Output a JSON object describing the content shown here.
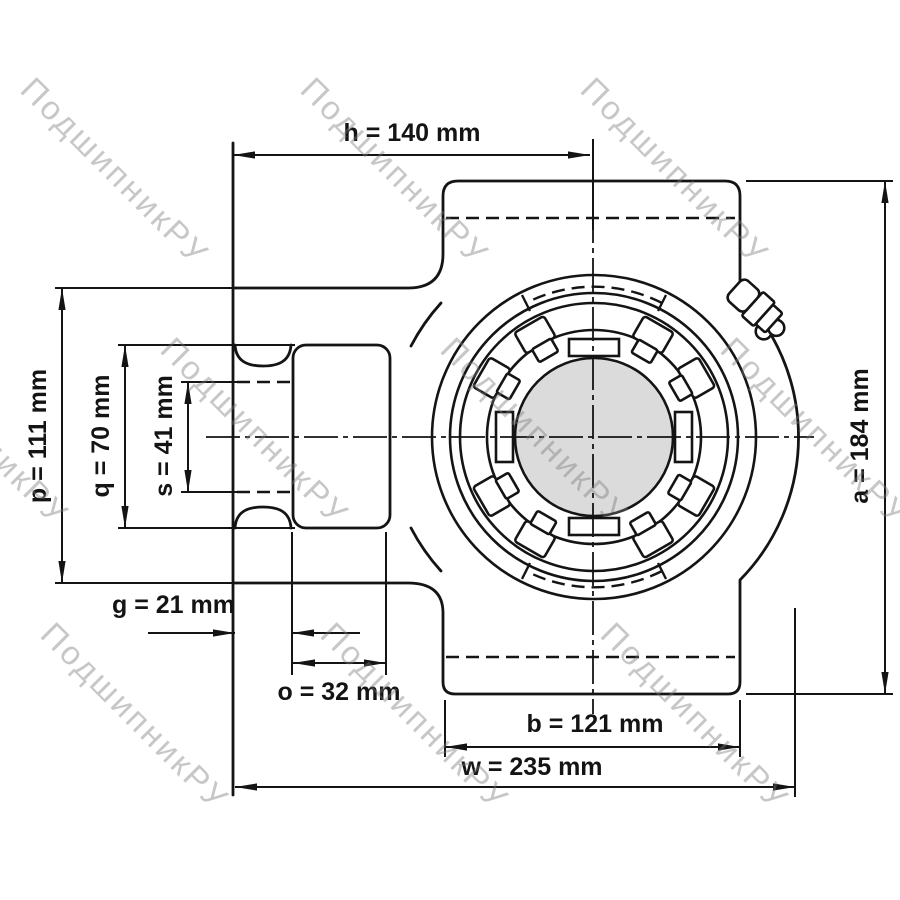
{
  "watermark": {
    "text": "ПодшипникРУ",
    "color": "#c4c4c4"
  },
  "drawing": {
    "line_color": "#141414",
    "bore_fill": "#dbdbdb",
    "background": "#ffffff"
  },
  "dimensions": {
    "h": {
      "label": "h = 140 mm"
    },
    "p": {
      "label": "p = 111 mm"
    },
    "q": {
      "label": "q = 70 mm"
    },
    "s": {
      "label": "s = 41 mm"
    },
    "g": {
      "label": "g = 21 mm"
    },
    "o": {
      "label": "o = 32 mm"
    },
    "b": {
      "label": "b = 121 mm"
    },
    "w": {
      "label": "w = 235 mm"
    },
    "a": {
      "label": "a = 184 mm"
    }
  }
}
